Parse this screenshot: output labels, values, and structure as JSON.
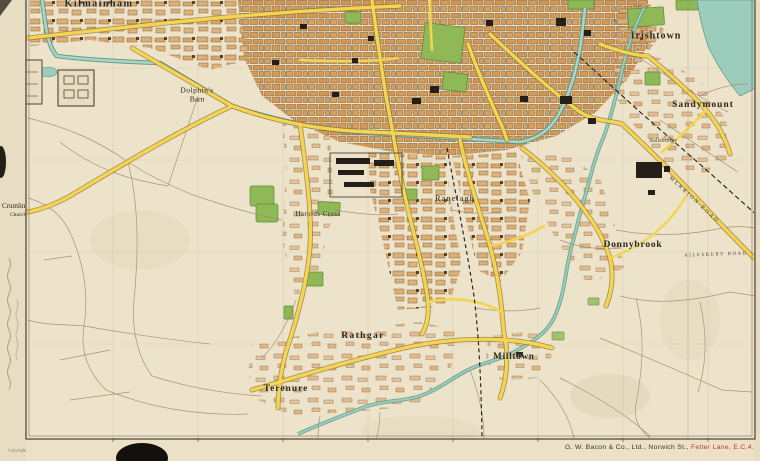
{
  "map": {
    "region_labels": [
      {
        "id": "kilmainham",
        "text": "Kilmainham",
        "x": 99,
        "y": 4
      },
      {
        "id": "dolphins",
        "text": "Dolphin's",
        "x": 197,
        "y": 90
      },
      {
        "id": "barn",
        "text": "Barn",
        "x": 197,
        "y": 99
      },
      {
        "id": "irishtown",
        "text": "Irishtown",
        "x": 656,
        "y": 36
      },
      {
        "id": "sandymount",
        "text": "Sandymount",
        "x": 703,
        "y": 105
      },
      {
        "id": "ballsbridge",
        "text": "Ballsbridge",
        "x": 663,
        "y": 141
      },
      {
        "id": "ranelagh",
        "text": "Ranelagh",
        "x": 455,
        "y": 198
      },
      {
        "id": "donnybrook",
        "text": "Donnybrook",
        "x": 633,
        "y": 245
      },
      {
        "id": "harolds-cross",
        "text": "Harolds Cross",
        "x": 318,
        "y": 214
      },
      {
        "id": "rathgar",
        "text": "Rathgar",
        "x": 363,
        "y": 336
      },
      {
        "id": "terenure",
        "text": "Terenure",
        "x": 286,
        "y": 389
      },
      {
        "id": "milltown",
        "text": "Milltown",
        "x": 514,
        "y": 356
      },
      {
        "id": "crumlin",
        "text": "Crumlin",
        "x": 2,
        "y": 206
      },
      {
        "id": "crumlin-church",
        "text": "Church",
        "x": 10,
        "y": 215
      }
    ],
    "road_labels": [
      {
        "id": "merrion-road",
        "text": "MERRION ROAD"
      },
      {
        "id": "ailesbury-road",
        "text": "AILESBURY ROAD"
      }
    ],
    "marginalia": {
      "copyright": "Copyright",
      "publisher": "G. W. Bacon & Co., Ltd., Norwich St.,",
      "publisher_address": "Fetter Lane, E.C.4."
    },
    "palette": {
      "paper": "#ece3ca",
      "city_block": "#d59a55",
      "suburb_block": "#e2bd91",
      "road_yellow": "#f3d551",
      "park_green": "#8fb957",
      "water_teal": "#9bccbc",
      "rail_black": "#201c16",
      "imprint_red": "#b63d2c"
    }
  }
}
